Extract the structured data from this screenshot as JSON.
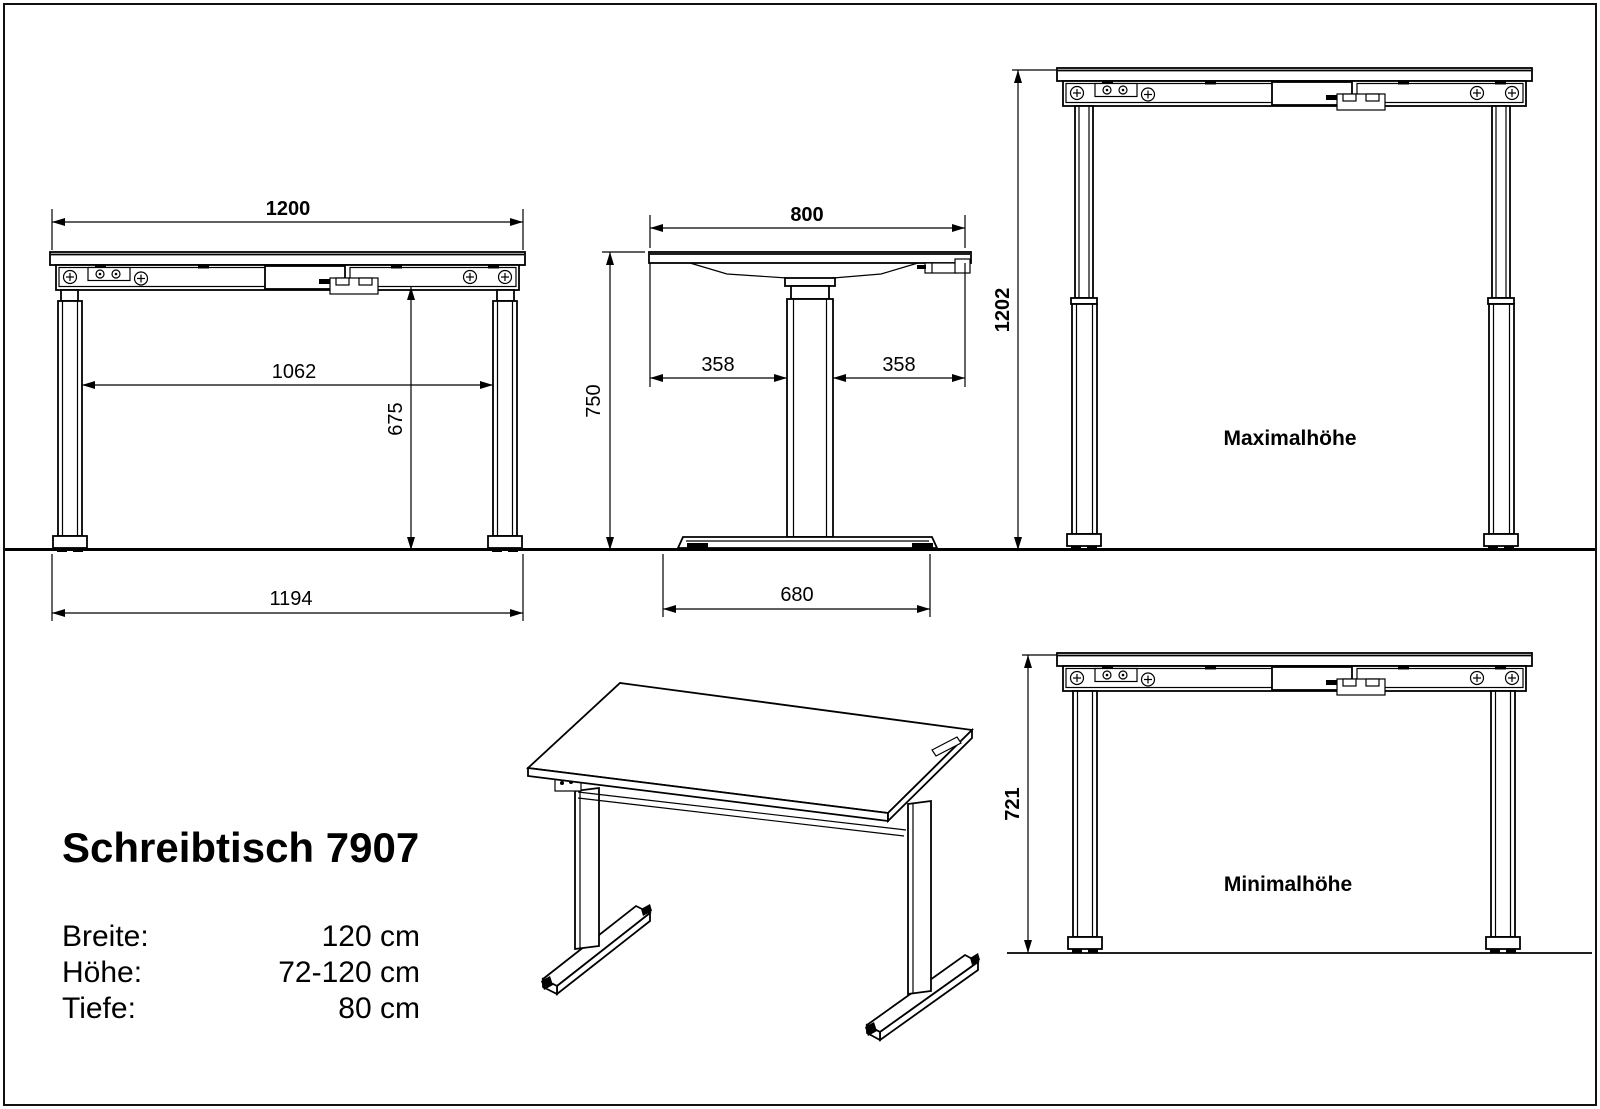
{
  "product": {
    "title": "Schreibtisch 7907",
    "specs": [
      {
        "label": "Breite:",
        "value": "120 cm"
      },
      {
        "label": "Höhe:",
        "value": "72-120 cm"
      },
      {
        "label": "Tiefe:",
        "value": "80 cm"
      }
    ]
  },
  "views": {
    "front_standard": {
      "dim_top_width": "1200",
      "dim_inner_width": "1062",
      "dim_underframe_height": "675",
      "dim_feet_width": "1194"
    },
    "side": {
      "dim_top_depth": "800",
      "dim_front_overhang": "358",
      "dim_back_overhang": "358",
      "dim_height": "750",
      "dim_foot_depth": "680"
    },
    "front_max": {
      "caption": "Maximalhöhe",
      "dim_height": "1202"
    },
    "front_min": {
      "caption": "Minimalhöhe",
      "dim_height": "721"
    }
  },
  "colors": {
    "line": "#000000",
    "background": "#ffffff"
  }
}
